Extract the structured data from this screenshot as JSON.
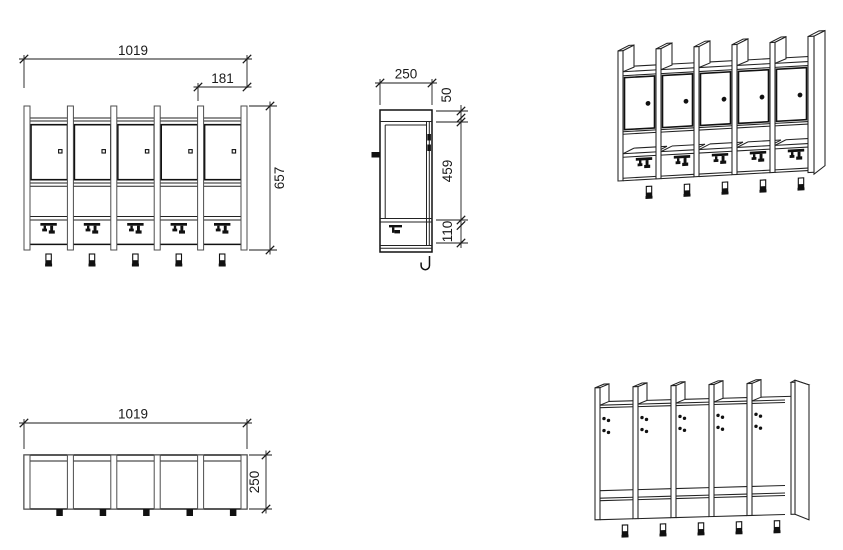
{
  "drawing": {
    "sections_count": 5,
    "colors": {
      "line": "#222222",
      "door_line": "#111111",
      "panel_edge": "#4d4d4d",
      "dimension": "#1a1a1a",
      "background": "#ffffff"
    },
    "views": {
      "front_elevation": {
        "dim_overall_width": "1019",
        "dim_section_width": "181",
        "dim_overall_height": "657"
      },
      "side_section": {
        "dim_depth": "250",
        "dim_top_rail": "50",
        "dim_door_zone": "459",
        "dim_bottom_zone": "110"
      },
      "top_plan": {
        "dim_overall_width": "1019",
        "dim_depth": "250"
      }
    }
  }
}
